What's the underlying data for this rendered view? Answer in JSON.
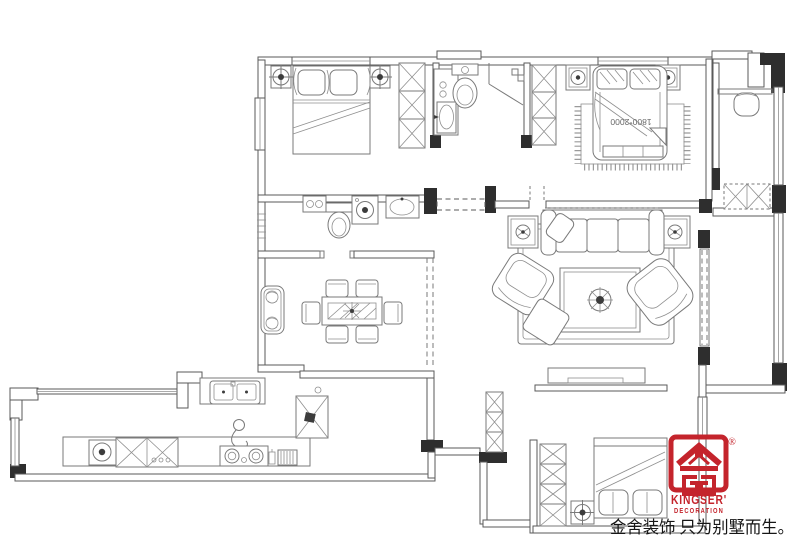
{
  "document": {
    "type": "residential-floor-plan"
  },
  "colors": {
    "line": "#7a7a7a",
    "wall": "#5a5a5a",
    "structure_dark": "#2e2e2e",
    "brand_red": "#c4242c",
    "text_dark": "#161616"
  },
  "plan": {
    "bed_size_label": "1800*2000"
  },
  "logo": {
    "brand": "KINGSER'",
    "subtitle": "DECORATION",
    "registered": "®"
  },
  "slogan": {
    "text": "金舍装饰 只为别墅而生。"
  },
  "icons": {
    "ceiling-light-icon": "circle-crosshair",
    "downlight-icon": "double-circle-dot",
    "wardrobe-icon": "x-box-column",
    "toilet-icon": "tank-and-bowl",
    "washing-machine-icon": "box-with-drum-circle",
    "plant-icon": "swirl-circle",
    "stove-icon": "two-burner-circles",
    "range-vent-icon": "hatched-box",
    "logo-emblem-icon": "red-house-seal"
  }
}
